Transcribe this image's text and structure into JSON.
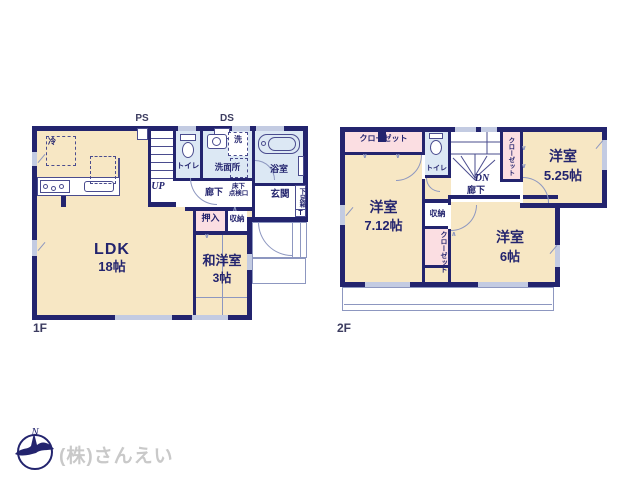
{
  "colors": {
    "wall": "#23246e",
    "cream": "#f7e7c4",
    "pink": "#fbdee2",
    "blue": "#dce8f4",
    "line": "#8d97c0",
    "win": "#c3cbe2",
    "text": "#23246e",
    "fixture": "#4a4c8e",
    "logo": "#c9c9c9"
  },
  "f1": {
    "floor": "1F",
    "ps": "PS",
    "ds": "DS",
    "up": "UP",
    "fridge": "冷",
    "washer": "洗",
    "toilet": "トイレ",
    "washroom": "洗面所",
    "bathroom": "浴室",
    "hallway": "廊下",
    "hatch_line1": "床下",
    "hatch_line2": "点検口",
    "entrance": "玄関",
    "shoe_box": "下足箱",
    "shoe_box_t": "T",
    "closet_oshiire": "押入",
    "storage": "収納",
    "ldk": "LDK",
    "ldk_size": "18帖",
    "tatami_room": "和洋室",
    "tatami_room_size": "3帖"
  },
  "f2": {
    "floor": "2F",
    "dn": "DN",
    "closet_top_left": "クローゼット",
    "closet_right": "クローゼット",
    "closet_mid": "クローゼット",
    "toilet": "トイレ",
    "hallway": "廊下",
    "storage": "収納",
    "room_a": "洋室",
    "room_a_size": "7.12帖",
    "room_b": "洋室",
    "room_b_size": "5.25帖",
    "room_c": "洋室",
    "room_c_size": "6帖"
  },
  "footer": {
    "company": "(株)さんえい",
    "compass": "N"
  }
}
